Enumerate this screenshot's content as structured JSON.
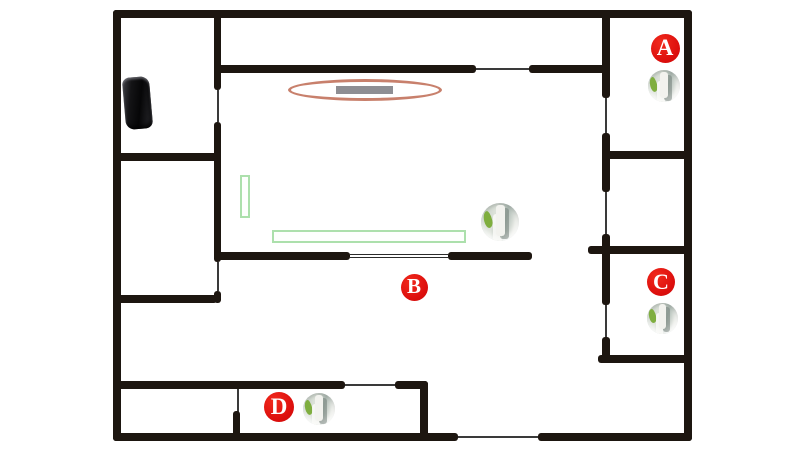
{
  "canvas": {
    "width": 800,
    "height": 453,
    "background": "#ffffff"
  },
  "colors": {
    "wall": "#1d1610",
    "door_line": "#3a3a3a",
    "label_background": "#dd0f0d",
    "label_text": "#ffffff",
    "coverage_ellipse_stroke": "#c8806c",
    "gray_bar_fill": "#8e8e93",
    "furniture_outline_green": "#ace0ac",
    "icon_leaf_green": "#7fae3f",
    "router_black": "#141416"
  },
  "labels": [
    {
      "id": "a",
      "text": "A",
      "cx": 665,
      "cy": 48,
      "d": 29
    },
    {
      "id": "b",
      "text": "B",
      "cx": 414,
      "cy": 287,
      "d": 27
    },
    {
      "id": "c",
      "text": "C",
      "cx": 661,
      "cy": 282,
      "d": 28
    },
    {
      "id": "d",
      "text": "D",
      "cx": 279,
      "cy": 407,
      "d": 30
    }
  ],
  "device_icons": [
    {
      "room": "a",
      "icon": "device-photo-icon",
      "cx": 664,
      "cy": 86,
      "d": 32
    },
    {
      "room": "hall",
      "icon": "device-photo-icon",
      "cx": 500,
      "cy": 222,
      "d": 38
    },
    {
      "room": "c",
      "icon": "device-photo-icon",
      "cx": 662,
      "cy": 318,
      "d": 31
    },
    {
      "room": "d",
      "icon": "device-photo-icon",
      "cx": 319,
      "cy": 409,
      "d": 32
    }
  ],
  "furniture": [
    {
      "name": "router-device",
      "kind": "router",
      "x": 124,
      "y": 77,
      "w": 27,
      "h": 52
    },
    {
      "name": "coverage-ellipse",
      "kind": "ellipse",
      "x": 288,
      "y": 79,
      "w": 154,
      "h": 22
    },
    {
      "name": "gray-bar",
      "kind": "bar",
      "x": 336,
      "y": 86,
      "w": 57,
      "h": 8
    },
    {
      "name": "green-rect-vertical",
      "kind": "greenrect",
      "x": 240,
      "y": 175,
      "w": 10,
      "h": 43
    },
    {
      "name": "green-rect-horizontal",
      "kind": "greenrect",
      "x": 272,
      "y": 230,
      "w": 194,
      "h": 13
    }
  ],
  "walls": [
    {
      "x": 113,
      "y": 10,
      "w": 579,
      "h": 8,
      "t": "wall"
    },
    {
      "x": 113,
      "y": 10,
      "w": 8,
      "h": 431,
      "t": "wall"
    },
    {
      "x": 684,
      "y": 10,
      "w": 8,
      "h": 431,
      "t": "wall"
    },
    {
      "x": 113,
      "y": 433,
      "w": 345,
      "h": 8,
      "t": "wall"
    },
    {
      "x": 458,
      "y": 436,
      "w": 80,
      "h": 2,
      "t": "door"
    },
    {
      "x": 538,
      "y": 433,
      "w": 154,
      "h": 8,
      "t": "wall"
    },
    {
      "x": 214,
      "y": 14,
      "w": 7,
      "h": 76,
      "t": "wall"
    },
    {
      "x": 217,
      "y": 90,
      "w": 2,
      "h": 32,
      "t": "door"
    },
    {
      "x": 214,
      "y": 122,
      "w": 7,
      "h": 140,
      "t": "wall"
    },
    {
      "x": 217,
      "y": 262,
      "w": 2,
      "h": 29,
      "t": "door"
    },
    {
      "x": 214,
      "y": 291,
      "w": 7,
      "h": 12,
      "t": "wall"
    },
    {
      "x": 117,
      "y": 153,
      "w": 100,
      "h": 8,
      "t": "wall"
    },
    {
      "x": 117,
      "y": 295,
      "w": 100,
      "h": 8,
      "t": "wall"
    },
    {
      "x": 214,
      "y": 65,
      "w": 262,
      "h": 8,
      "t": "wall"
    },
    {
      "x": 476,
      "y": 68,
      "w": 53,
      "h": 2,
      "t": "door"
    },
    {
      "x": 529,
      "y": 65,
      "w": 81,
      "h": 8,
      "t": "wall"
    },
    {
      "x": 602,
      "y": 14,
      "w": 8,
      "h": 84,
      "t": "wall"
    },
    {
      "x": 605,
      "y": 98,
      "w": 2,
      "h": 35,
      "t": "door"
    },
    {
      "x": 602,
      "y": 133,
      "w": 8,
      "h": 59,
      "t": "wall"
    },
    {
      "x": 605,
      "y": 192,
      "w": 2,
      "h": 42,
      "t": "door"
    },
    {
      "x": 602,
      "y": 234,
      "w": 8,
      "h": 71,
      "t": "wall"
    },
    {
      "x": 605,
      "y": 305,
      "w": 2,
      "h": 32,
      "t": "door"
    },
    {
      "x": 602,
      "y": 337,
      "w": 8,
      "h": 26,
      "t": "wall"
    },
    {
      "x": 602,
      "y": 151,
      "w": 90,
      "h": 8,
      "t": "wall"
    },
    {
      "x": 588,
      "y": 246,
      "w": 104,
      "h": 8,
      "t": "wall"
    },
    {
      "x": 598,
      "y": 355,
      "w": 94,
      "h": 8,
      "t": "wall"
    },
    {
      "x": 214,
      "y": 252,
      "w": 136,
      "h": 8,
      "t": "wall"
    },
    {
      "x": 350,
      "y": 254,
      "w": 98,
      "h": 4,
      "t": "track"
    },
    {
      "x": 448,
      "y": 252,
      "w": 84,
      "h": 8,
      "t": "wall"
    },
    {
      "x": 113,
      "y": 381,
      "w": 232,
      "h": 8,
      "t": "wall"
    },
    {
      "x": 345,
      "y": 384,
      "w": 50,
      "h": 2,
      "t": "door"
    },
    {
      "x": 395,
      "y": 381,
      "w": 33,
      "h": 8,
      "t": "wall"
    },
    {
      "x": 420,
      "y": 381,
      "w": 8,
      "h": 60,
      "t": "wall"
    },
    {
      "x": 237,
      "y": 389,
      "w": 2,
      "h": 24,
      "t": "door"
    },
    {
      "x": 233,
      "y": 411,
      "w": 7,
      "h": 26,
      "t": "wall"
    }
  ]
}
